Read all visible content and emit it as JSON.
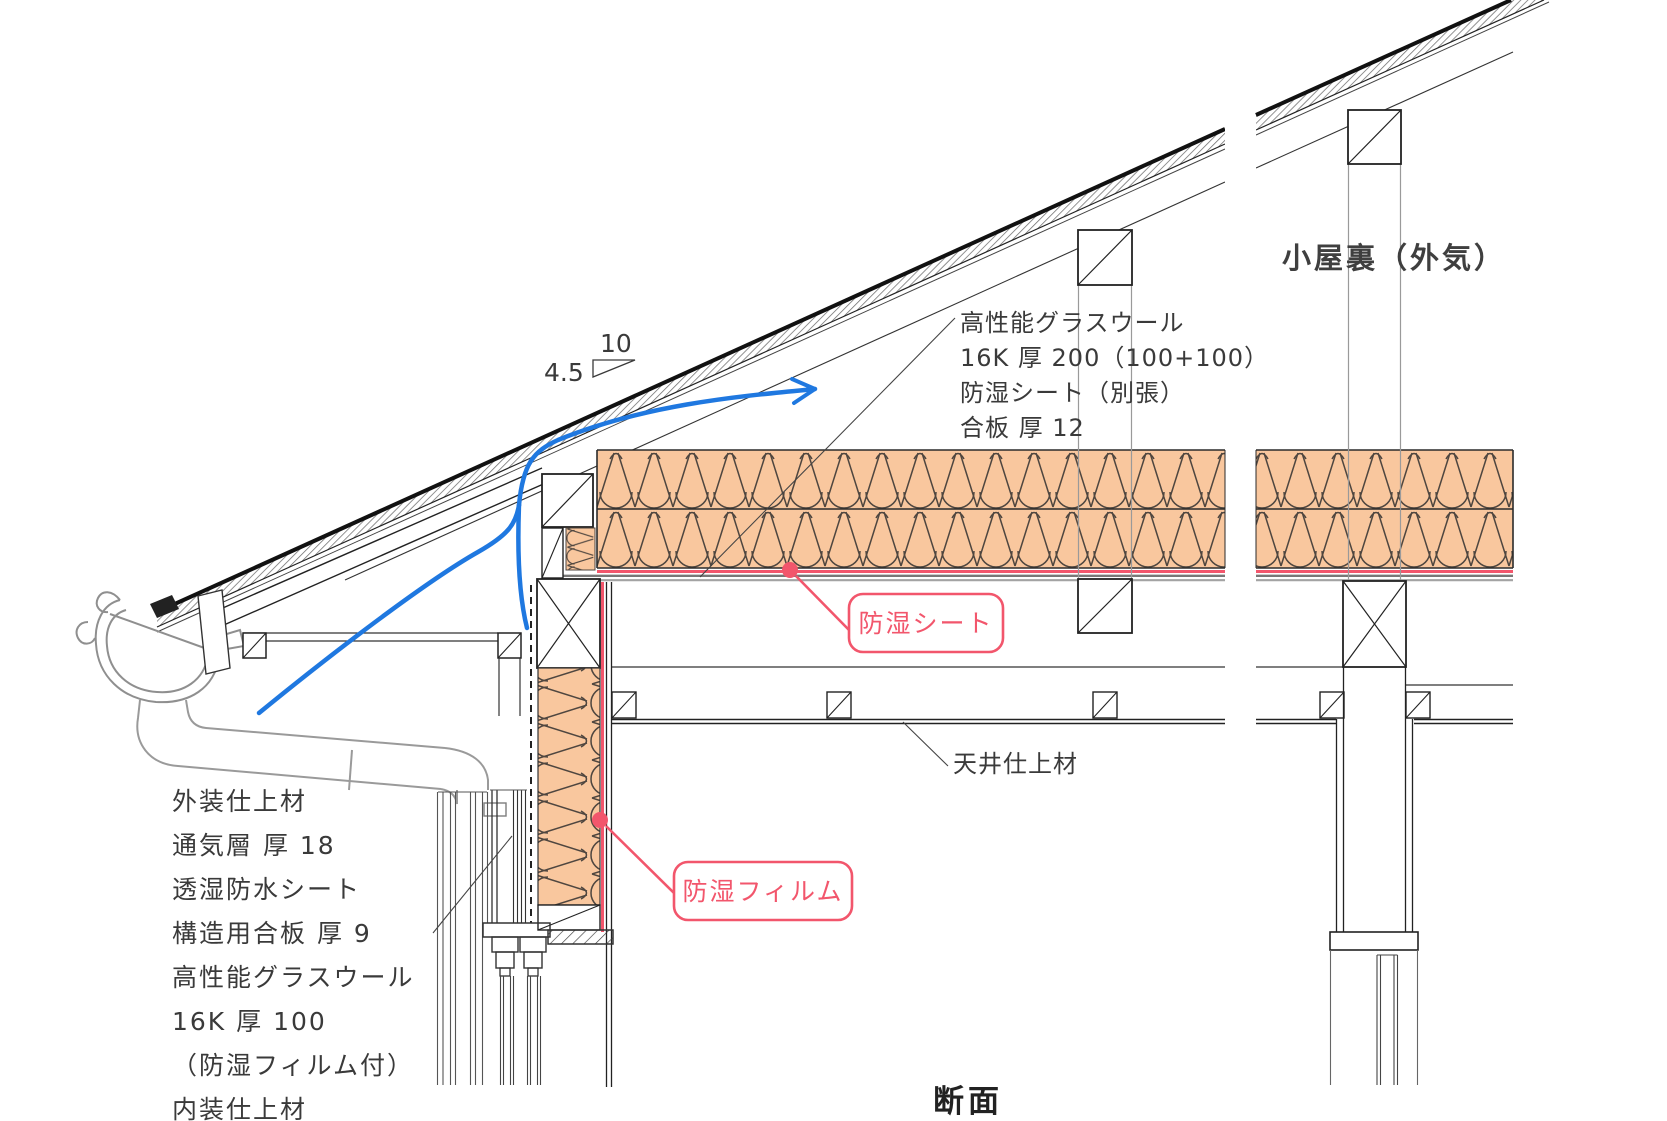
{
  "title": "断面",
  "attic_label": "小屋裏（外気）",
  "slope_marker": {
    "rise": "4.5",
    "run": "10"
  },
  "roof_assembly_note": {
    "lines": [
      "高性能グラスウール",
      "16K 厚 200（100+100）",
      "防湿シート（別張）",
      "合板 厚 12"
    ]
  },
  "wall_assembly_note": {
    "lines": [
      "外装仕上材",
      "通気層 厚 18",
      "透湿防水シート",
      "構造用合板 厚 9",
      "高性能グラスウール",
      "16K 厚 100",
      "（防湿フィルム付）",
      "内装仕上材"
    ]
  },
  "ceiling_label": "天井仕上材",
  "callouts": {
    "vapor_sheet": "防湿シート",
    "vapor_film": "防湿フィルム"
  },
  "colors": {
    "insulation_fill": "#f9c79e",
    "insulation_stroke": "#4f463f",
    "annotation_red": "#f2566c",
    "airflow_blue": "#1f78e0",
    "line_dark": "#1a1a1a"
  }
}
